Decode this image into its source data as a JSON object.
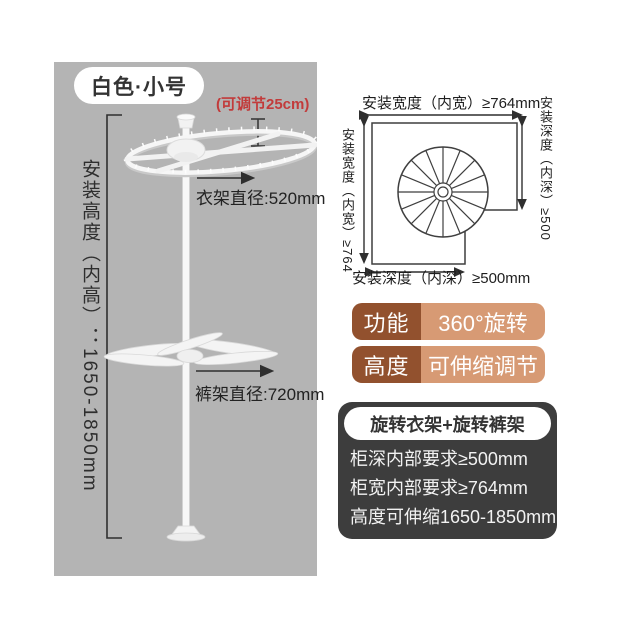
{
  "photo_panel": {
    "bg_color": "#b4b4b4",
    "variant_badge": "白色·小号",
    "adjust_note": "(可调节25cm)",
    "height_label": "安装高度（内高）：1650-1850mm",
    "hanger_diameter_label": "衣架直径:520mm",
    "pants_diameter_label": "裤架直径:720mm"
  },
  "install_diagram": {
    "top_label": "安装宽度（内宽）≥764mm",
    "left_label": "安装宽度（内宽）≥764",
    "right_label": "安装深度（内深）≥500",
    "bottom_label": "安装深度（内深）≥500mm"
  },
  "feature_badges": [
    {
      "key": "功能",
      "value": "360°旋转"
    },
    {
      "key": "高度",
      "value": "可伸缩调节"
    }
  ],
  "spec_box": {
    "title": "旋转衣架+旋转裤架",
    "lines": [
      "柜深内部要求≥500mm",
      "柜宽内部要求≥764mm",
      "高度可伸缩1650-1850mm"
    ]
  },
  "colors": {
    "photo_bg": "#b4b4b4",
    "badge_key_bg": "#92512e",
    "badge_value_bg": "#d79a74",
    "spec_box_bg": "#3d3d3d",
    "note_red": "#c23b3b"
  }
}
